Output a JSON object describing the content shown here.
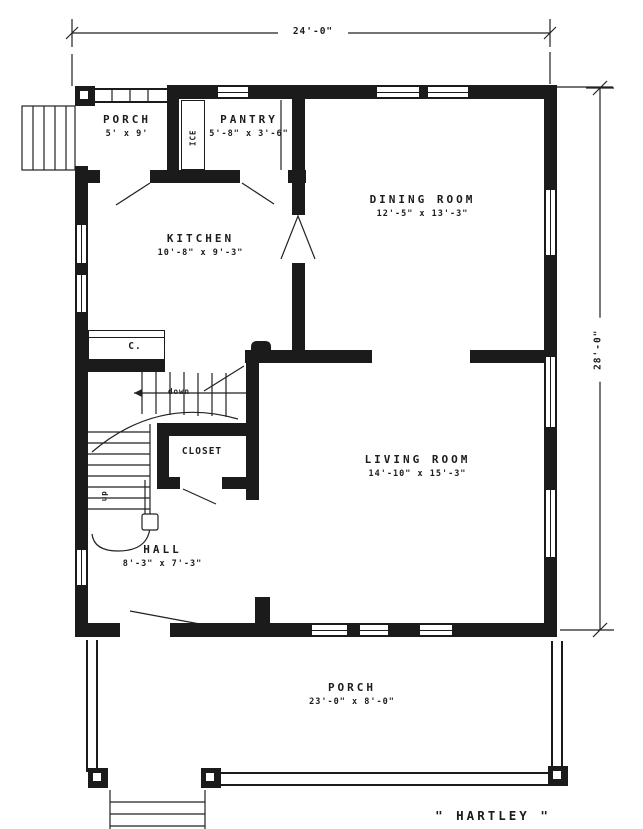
{
  "title": "\" HARTLEY \"",
  "dimensions": {
    "top": "24'-0\"",
    "right": "28'-0\""
  },
  "rooms": {
    "back_porch": {
      "label": "PORCH",
      "size": "5' x 9'"
    },
    "pantry": {
      "label": "PANTRY",
      "size": "5'-8\" x 3'-6\""
    },
    "dining": {
      "label": "DINING ROOM",
      "size": "12'-5\" x 13'-3\""
    },
    "kitchen": {
      "label": "KITCHEN",
      "size": "10'-8\" x 9'-3\""
    },
    "closet": {
      "label": "CLOSET"
    },
    "hall": {
      "label": "HALL",
      "size": "8'-3\" x 7'-3\""
    },
    "living": {
      "label": "LIVING ROOM",
      "size": "14'-10\" x 15'-3\""
    },
    "front_porch": {
      "label": "PORCH",
      "size": "23'-0\" x 8'-0\""
    }
  },
  "annotations": {
    "ice": "ICE",
    "china_closet": "C.",
    "stairs_down": "down",
    "stairs_up": "up"
  },
  "colors": {
    "ink": "#1b1b1b",
    "paper": "#ffffff"
  }
}
